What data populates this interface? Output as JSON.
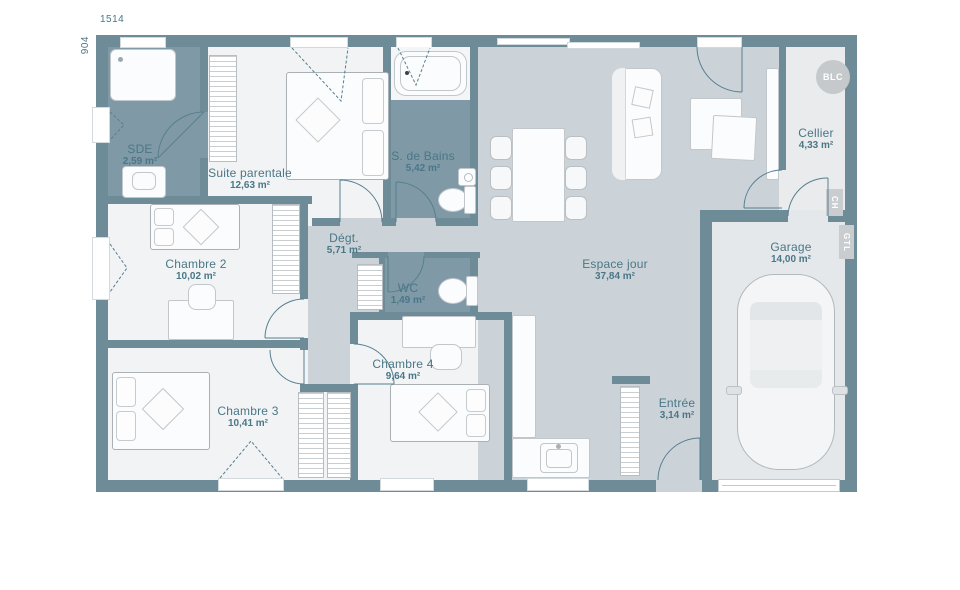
{
  "plan": {
    "title": "maison plain-pied plan",
    "dimensions": {
      "width": "1514",
      "height": "904"
    },
    "rooms": [
      {
        "name": "SDE",
        "area": "2,59 m²"
      },
      {
        "name": "Suite parentale",
        "area": "12,63 m²"
      },
      {
        "name": "Chambre 2",
        "area": "10,02 m²"
      },
      {
        "name": "Chambre 3",
        "area": "10,41 m²"
      },
      {
        "name": "Chambre 4",
        "area": "9,64 m²"
      },
      {
        "name": "S. de Bains",
        "area": "5,42 m²"
      },
      {
        "name": "Dégt.",
        "area": "5,71 m²"
      },
      {
        "name": "WC",
        "area": "1,49 m²"
      },
      {
        "name": "Espace jour",
        "area": "37,84 m²"
      },
      {
        "name": "Entrée",
        "area": "3,14 m²"
      },
      {
        "name": "Cellier",
        "area": "4,33 m²"
      },
      {
        "name": "Garage",
        "area": "14,00 m²"
      }
    ],
    "tags": {
      "water_heater": "BLC",
      "boiler": "CH",
      "gtl": "GTL"
    },
    "colors": {
      "wall": "#6e8b98",
      "floor_day": "#ccd3d8",
      "floor_bedroom": "#f2f3f4",
      "floor_wet": "#7f99a6",
      "floor_cellier": "#e9ebed",
      "floor_garage": "#e5e8ea",
      "label_text": "#4a7787"
    }
  }
}
